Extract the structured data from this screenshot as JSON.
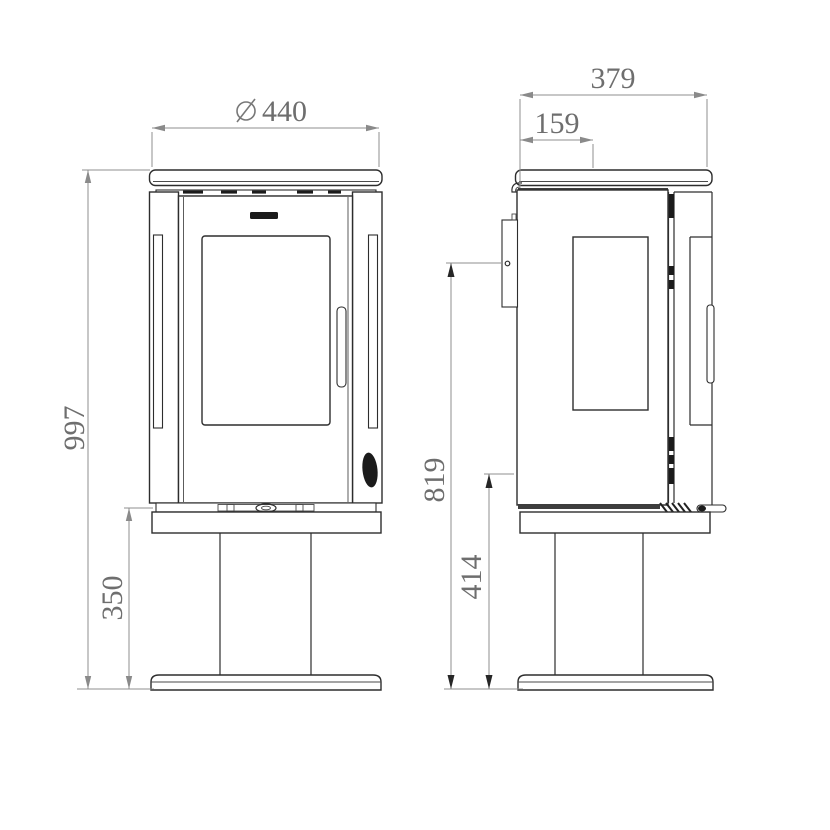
{
  "drawing": {
    "type": "technical-dimension-drawing",
    "subject": "pedestal wood stove, front and side elevation views",
    "units_shown": "mm (implied)",
    "line_color": "#2d2d2d",
    "dimension_color": "#8f8f8f",
    "text_color": "#6e6e6e",
    "background": "#ffffff"
  },
  "dimensions": {
    "diameter_symbol": "⌀",
    "top_diameter": "440",
    "overall_height": "997",
    "pedestal_height": "350",
    "depth": "379",
    "top_outlet_offset": "159",
    "rear_outlet_height": "819",
    "firebox_bottom_height": "414"
  }
}
